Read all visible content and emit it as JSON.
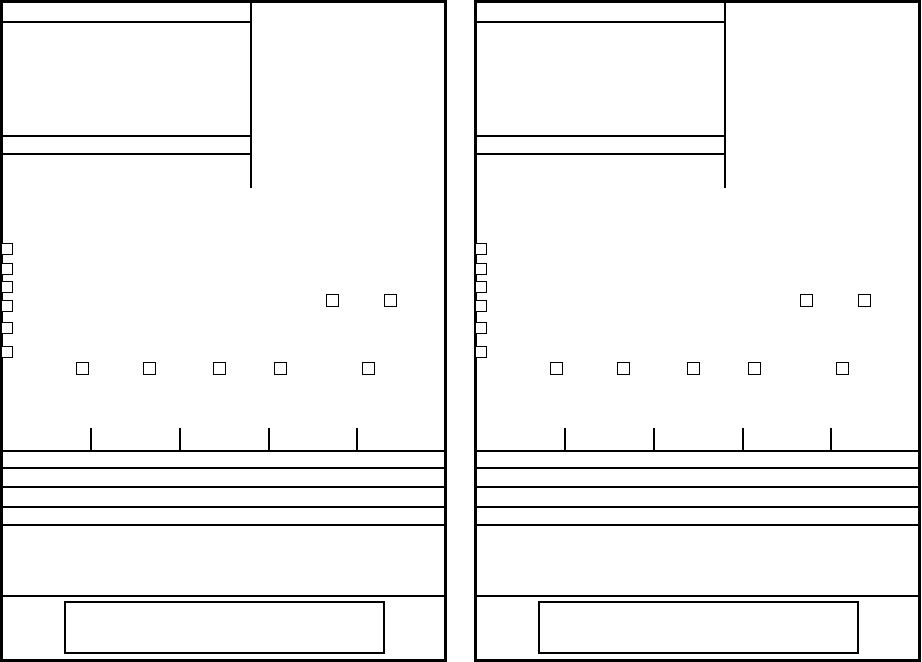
{
  "document": {
    "kind": "blank-two-part-form",
    "visible_text": "",
    "colors": {
      "ink": "#000000",
      "paper": "#ffffff"
    }
  },
  "panels": [
    {
      "name": "payment-slip-left",
      "x": 0
    },
    {
      "name": "payment-slip-right",
      "x": 474
    }
  ],
  "slip_geometry": {
    "width": 447,
    "height": 662,
    "header": {
      "divider_x": 250,
      "divider_height": 188,
      "partial_rules_y": [
        21,
        135,
        153
      ],
      "partial_rules_width": 252
    },
    "edge_checkboxes": {
      "left": 1,
      "size": 12,
      "tops": [
        243,
        263,
        281,
        300,
        322,
        346
      ]
    },
    "pair_checkboxes": {
      "top": 294,
      "size": 13,
      "lefts": [
        326,
        384
      ]
    },
    "row_checkboxes": {
      "top": 362,
      "size": 13,
      "lefts": [
        76,
        143,
        213,
        274,
        362
      ]
    },
    "tick_marks": {
      "top": 428,
      "height": 22,
      "lefts": [
        90,
        179,
        268,
        356
      ]
    },
    "full_rules_y": [
      450,
      467,
      486,
      506,
      524,
      595
    ],
    "footer_box": {
      "left": 64,
      "top": 601,
      "width": 321,
      "height": 53
    }
  }
}
